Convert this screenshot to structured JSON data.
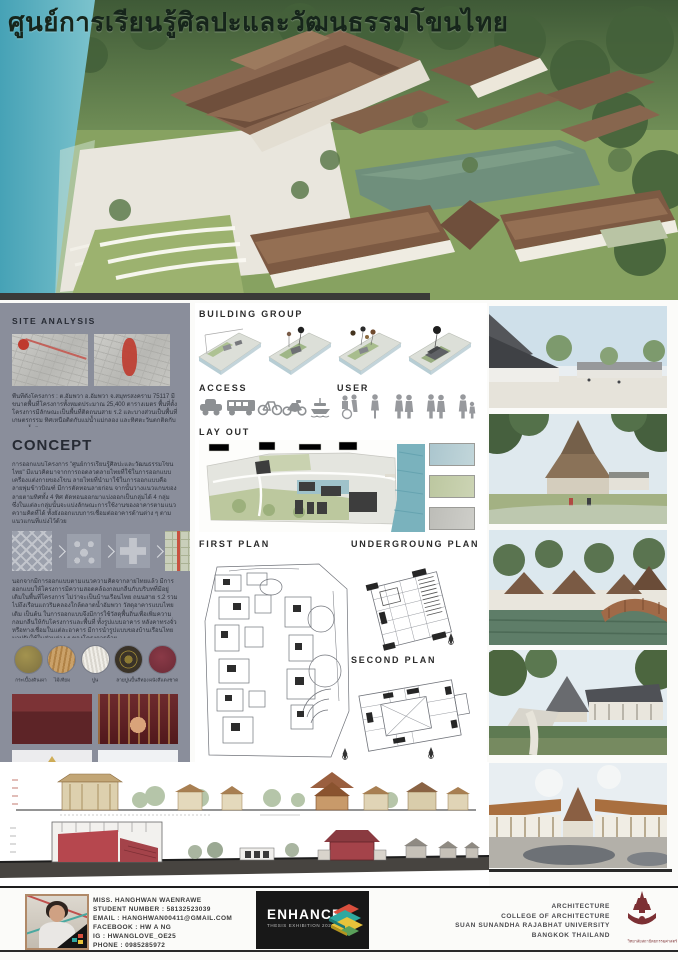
{
  "poster": {
    "title": "ศูนย์การเรียนรู้ศิลปะและวัฒนธรรมโขนไทย"
  },
  "left_panel": {
    "site_analysis": {
      "heading": "SITE ANALYSIS",
      "description": "พื้นที่ตั้งโครงการ : ต.อัมพวา อ.อัมพวา จ.สมุทรสงคราม 75117 มีขนาดพื้นที่โครงการทั้งหมดประมาณ 25,400 ตารางเมตร พื้นที่ตั้งโครงการมีลักษณะเป็นพื้นที่ติดถนนสาย ร.2 และบางส่วนเป็นพื้นที่เกษตรกรรม ทิศเหนือติดกับแม่น้ำแม่กลอง และทิศตะวันตกติดกับตลาดน้ำอัมพวา"
    },
    "concept": {
      "heading": "CONCEPT",
      "paragraph1": "การออกแบบโครงการ \"ศูนย์การเรียนรู้ศิลปะและวัฒนธรรมโขนไทย\" มีแนวคิดมาจากการถอดลวดลายไทยที่ใช้ในการออกแบบเครื่องแต่งกายของโขน ลายไทยที่นำมาใช้ในการออกแบบคือ ลายพุ่มข้าวบิณฑ์ มีการตัดทอนลายก่อน จากนั้นวางแนวแกนของลายตามทิศทั้ง 4 ทิศ ตัดทอนออกมาแบ่งออกเป็นกลุ่มได้ 4 กลุ่ม ซึ่งในแต่ละกลุ่มนั้นจะแบ่งลักษณะการใช้งานของอาคารตามแนวความคิดที่ได้ ทั้งยังออกแบบการเชื่อมต่ออาคารด้านต่าง ๆ ตามแนวแกนที่แบ่งไว้ด้วย",
      "paragraph2": "นอกจากมีการออกแบบตามแนวความคิดจากลายไทยแล้ว มีการออกแบบให้โครงการมีความสอดคล้องกลมกลืนกับบริบทที่มีอยู่เดิมในพื้นที่โครงการ ไม่ว่าจะเป็นบ้านเรือนไทย ถนนสาย ร.2 รวมไปถึงเรือนแถวริมคลองใกล้ตลาดน้ำอัมพวา วัสดุอาคารแบบไทยเดิม เป็นต้น ในการออกแบบจึงมีการใช้วัสดุพื้นถิ่นเพื่อเพิ่มความกลมกลืนให้กับโครงการและพื้นที่ ทั้งรูปแบบอาคาร หลังคาทรงจั่ว หรือทางเชื่อมในแต่ละอาคาร มีการนำรูปแบบของบ้านเรือนไทยมาปรับใช้ในส่วนต่าง ๆ ของโครงการด้วย",
      "materials": [
        {
          "label": "กระเบื้องดินเผา",
          "color": "#8f7f4c"
        },
        {
          "label": "ไม้เทียม",
          "color": "#c49a62"
        },
        {
          "label": "ปูน",
          "color": "#e9e6df"
        },
        {
          "label": "ลายปูนปั้นสีทอง",
          "color": "#8c7a33"
        },
        {
          "label": "ผนังสีแดงชาด",
          "color": "#79303d"
        }
      ]
    }
  },
  "center_panel": {
    "building_group": {
      "heading": "BUILDING GROUP",
      "access_label": "ACCESS",
      "user_label": "USER",
      "access_icons": [
        "car",
        "bus",
        "bicycle",
        "motorcycle",
        "boat"
      ],
      "user_icons": [
        "wheelchair-visitor",
        "single-visitor",
        "couple",
        "family",
        "parent-and-child"
      ]
    },
    "layout": {
      "heading": "LAY OUT",
      "legend_colors": [
        "#abc6ce",
        "#bcc7a0",
        "#bdbdb8"
      ]
    },
    "plans": {
      "first": "FIRST PLAN",
      "underground": "UNDERGROUNG PLAN",
      "second": "SECOND PLAN"
    }
  },
  "footer": {
    "student": {
      "lines": [
        "MISS. HANGHWAN WAENRAWE",
        "STUDENT NUMBER : 58132523039",
        "EMAIL : HANGHWAN00411@GMAIL.COM",
        "FACEBOOK : HW A NG",
        "IG : HWANGLOVE_OE25",
        "PHONE : 0985285972"
      ]
    },
    "exhibition": {
      "title": "ENHANCE",
      "subtitle": "THESIS EXHIBITION 2020"
    },
    "university": {
      "lines": [
        "ARCHITECTURE",
        "COLLEGE OF ARCHITECTURE",
        "SUAN SUNANDHA RAJABHAT UNIVERSITY",
        "BANGKOK THAILAND"
      ],
      "emblem_caption": "วิทยาลัยสถาปัตยกรรมศาสตร์"
    }
  }
}
